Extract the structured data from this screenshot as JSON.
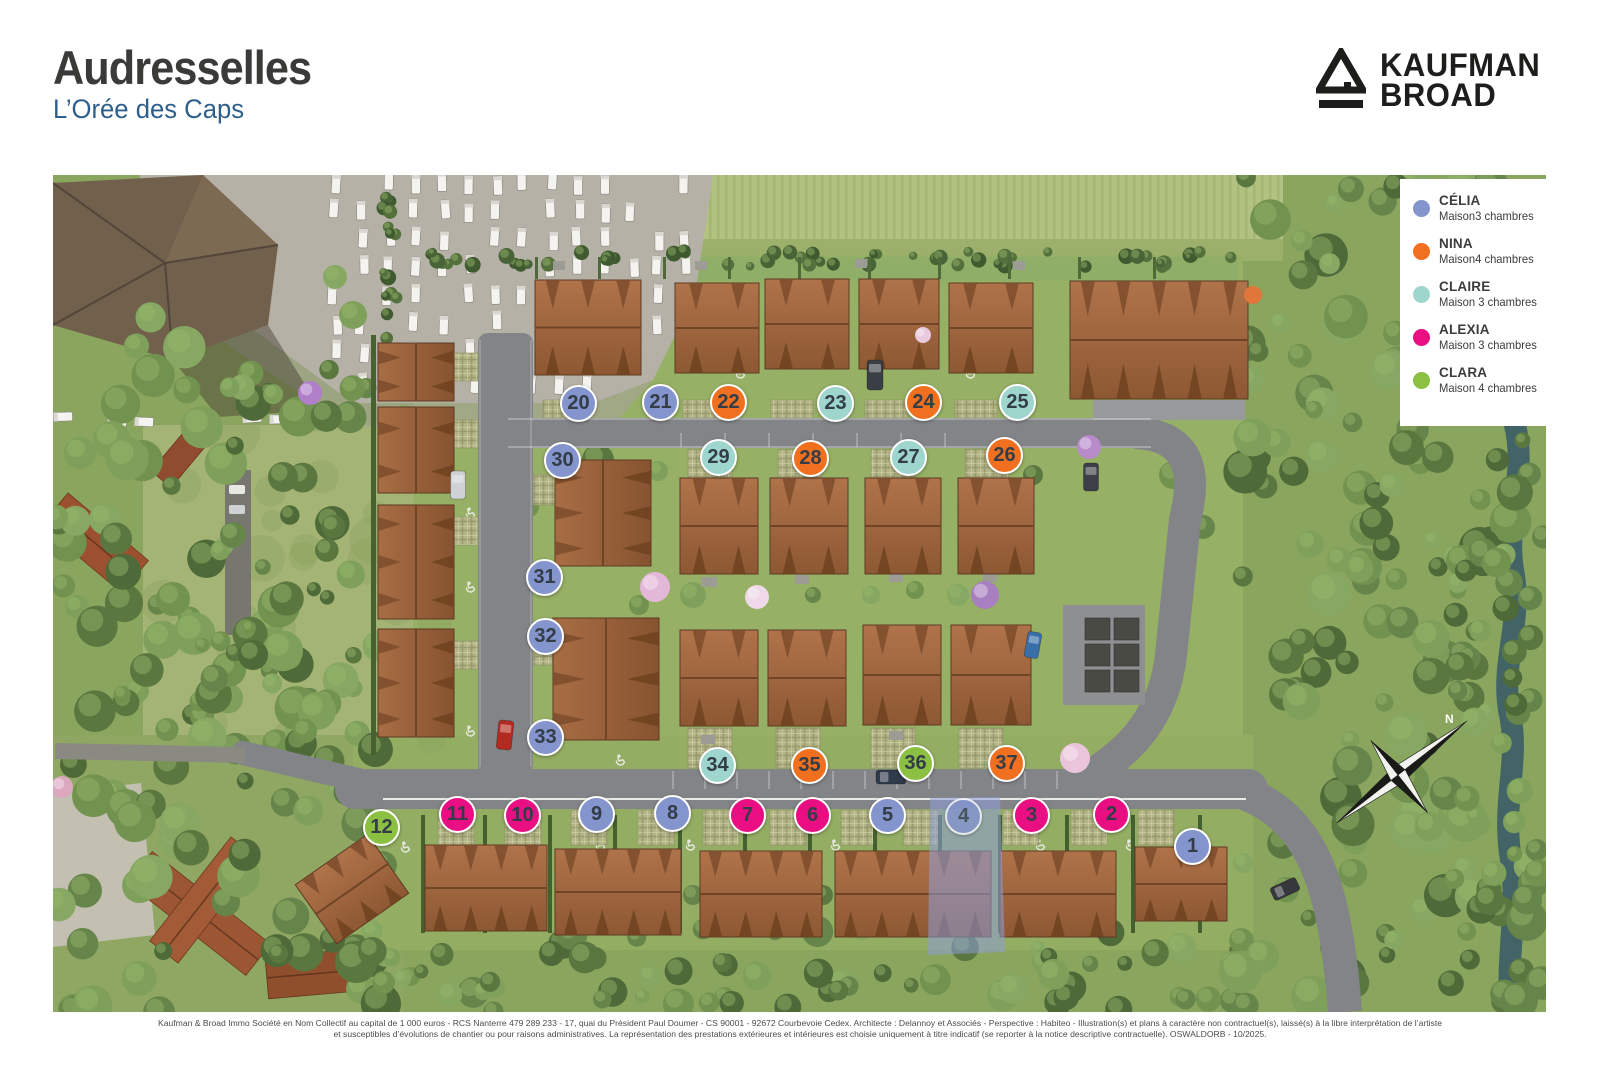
{
  "header": {
    "title": "Audresselles",
    "subtitle": "L’Orée des Caps"
  },
  "brand": {
    "line1": "KAUFMAN",
    "line2": "BROAD"
  },
  "legend": {
    "items": [
      {
        "name": "CÉLIA",
        "desc": "Maison3 chambres",
        "color": "#8494cd"
      },
      {
        "name": "NINA",
        "desc": "Maison4 chambres",
        "color": "#f1701f"
      },
      {
        "name": "CLAIRE",
        "desc": "Maison 3 chambres",
        "color": "#9ed5cd"
      },
      {
        "name": "ALEXIA",
        "desc": "Maison 3 chambres",
        "color": "#e90e82"
      },
      {
        "name": "CLARA",
        "desc": "Maison 4 chambres",
        "color": "#8cc043"
      }
    ]
  },
  "map": {
    "compass_label": "N",
    "type_colors": {
      "celia": "#8494cd",
      "nina": "#f1701f",
      "claire": "#9ed5cd",
      "alexia": "#e90e82",
      "clara": "#8cc043"
    },
    "selected_lot": "4",
    "lots": [
      {
        "num": "1",
        "type": "celia",
        "x": 1140,
        "y": 672
      },
      {
        "num": "2",
        "type": "alexia",
        "x": 1059,
        "y": 640
      },
      {
        "num": "3",
        "type": "alexia",
        "x": 979,
        "y": 641
      },
      {
        "num": "4",
        "type": "celia",
        "x": 911,
        "y": 642,
        "selected": true
      },
      {
        "num": "5",
        "type": "celia",
        "x": 835,
        "y": 641
      },
      {
        "num": "6",
        "type": "alexia",
        "x": 760,
        "y": 641
      },
      {
        "num": "7",
        "type": "alexia",
        "x": 695,
        "y": 641
      },
      {
        "num": "8",
        "type": "celia",
        "x": 620,
        "y": 639
      },
      {
        "num": "9",
        "type": "celia",
        "x": 544,
        "y": 640
      },
      {
        "num": "10",
        "type": "alexia",
        "x": 470,
        "y": 641
      },
      {
        "num": "11",
        "type": "alexia",
        "x": 405,
        "y": 640
      },
      {
        "num": "12",
        "type": "clara",
        "x": 329,
        "y": 653
      },
      {
        "num": "20",
        "type": "celia",
        "x": 526,
        "y": 229
      },
      {
        "num": "21",
        "type": "celia",
        "x": 608,
        "y": 228
      },
      {
        "num": "22",
        "type": "nina",
        "x": 676,
        "y": 228
      },
      {
        "num": "23",
        "type": "claire",
        "x": 783,
        "y": 229
      },
      {
        "num": "24",
        "type": "nina",
        "x": 871,
        "y": 228
      },
      {
        "num": "25",
        "type": "claire",
        "x": 965,
        "y": 228
      },
      {
        "num": "26",
        "type": "nina",
        "x": 952,
        "y": 281
      },
      {
        "num": "27",
        "type": "claire",
        "x": 856,
        "y": 283
      },
      {
        "num": "28",
        "type": "nina",
        "x": 758,
        "y": 284
      },
      {
        "num": "29",
        "type": "claire",
        "x": 666,
        "y": 283
      },
      {
        "num": "30",
        "type": "celia",
        "x": 510,
        "y": 286
      },
      {
        "num": "31",
        "type": "celia",
        "x": 492,
        "y": 403
      },
      {
        "num": "32",
        "type": "celia",
        "x": 493,
        "y": 462
      },
      {
        "num": "33",
        "type": "celia",
        "x": 493,
        "y": 563
      },
      {
        "num": "34",
        "type": "claire",
        "x": 665,
        "y": 591
      },
      {
        "num": "35",
        "type": "nina",
        "x": 757,
        "y": 591
      },
      {
        "num": "36",
        "type": "clara",
        "x": 863,
        "y": 589
      },
      {
        "num": "37",
        "type": "nina",
        "x": 954,
        "y": 589
      }
    ]
  },
  "footer": {
    "line1": "Kaufman & Broad Immo Société en Nom Collectif au capital de 1 000 euros - RCS Nanterre 479 289 233 - 17, quai du Président Paul Doumer - CS 90001 - 92672 Courbevoie Cedex. Architecte : Delannoy et Associés - Perspective : Habiteo - Illustration(s) et plans à caractère non contractuel(s), laissé(s) à la libre interprétation de l’artiste",
    "line2": "et susceptibles d’évolutions de chantier ou pour raisons administratives. La représentation des prestations extérieures et intérieures est choisie uniquement à titre indicatif (se reporter à la notice descriptive contractuelle). OSWALDORB - 10/2025."
  }
}
